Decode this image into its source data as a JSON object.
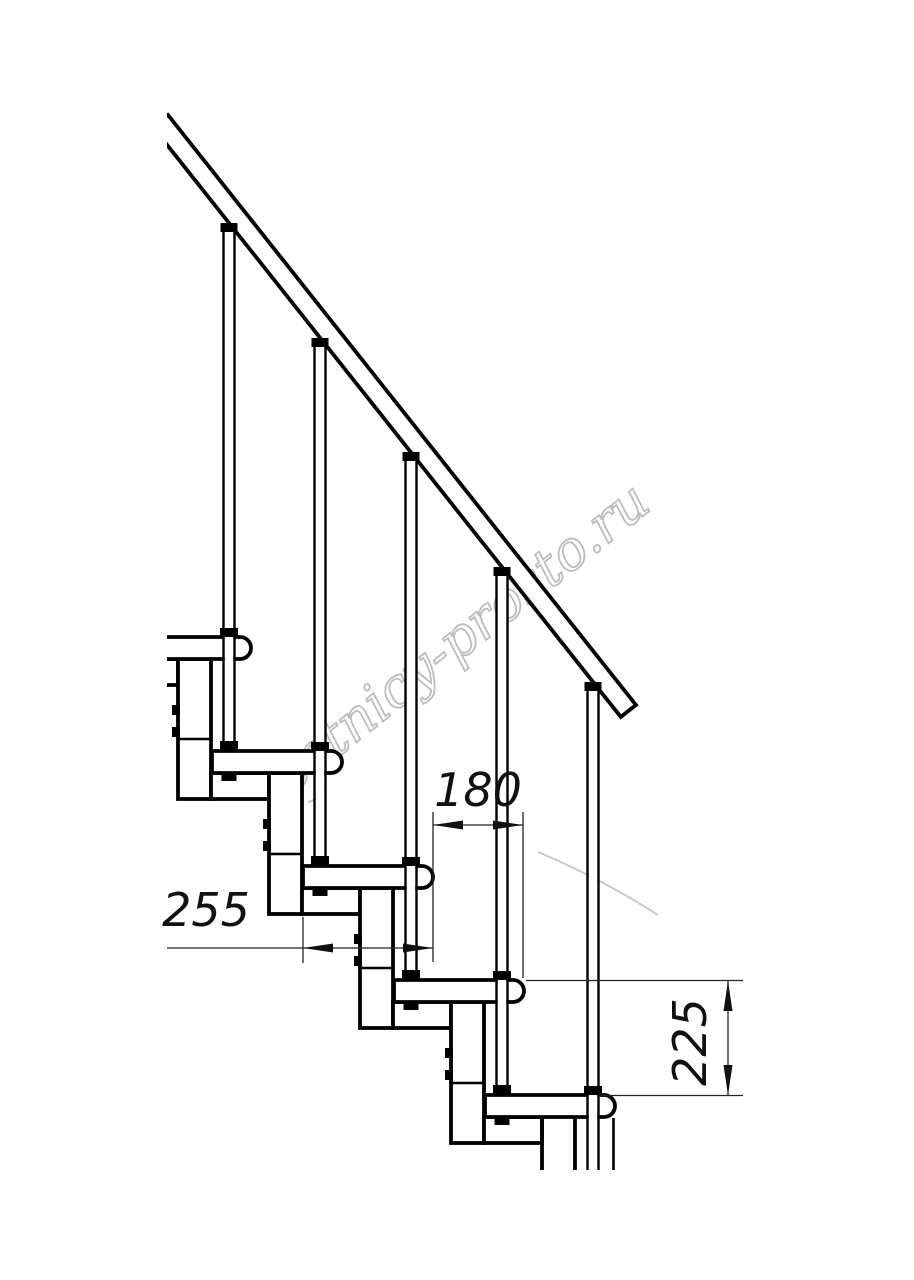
{
  "drawing": {
    "title": "modular-staircase-side-view",
    "background": "#ffffff",
    "line_color": "#000000",
    "dimension_color": "#111111",
    "watermark": {
      "text": "lestnicy-prosto.ru",
      "color": "#bdbdbd"
    },
    "dimensions": {
      "step_run": {
        "label": "180",
        "value": 180,
        "unit": "mm",
        "orientation": "horizontal"
      },
      "tread_depth": {
        "label": "255",
        "value": 255,
        "unit": "mm",
        "orientation": "horizontal"
      },
      "step_rise": {
        "label": "225",
        "value": 225,
        "unit": "mm",
        "orientation": "vertical"
      }
    }
  }
}
